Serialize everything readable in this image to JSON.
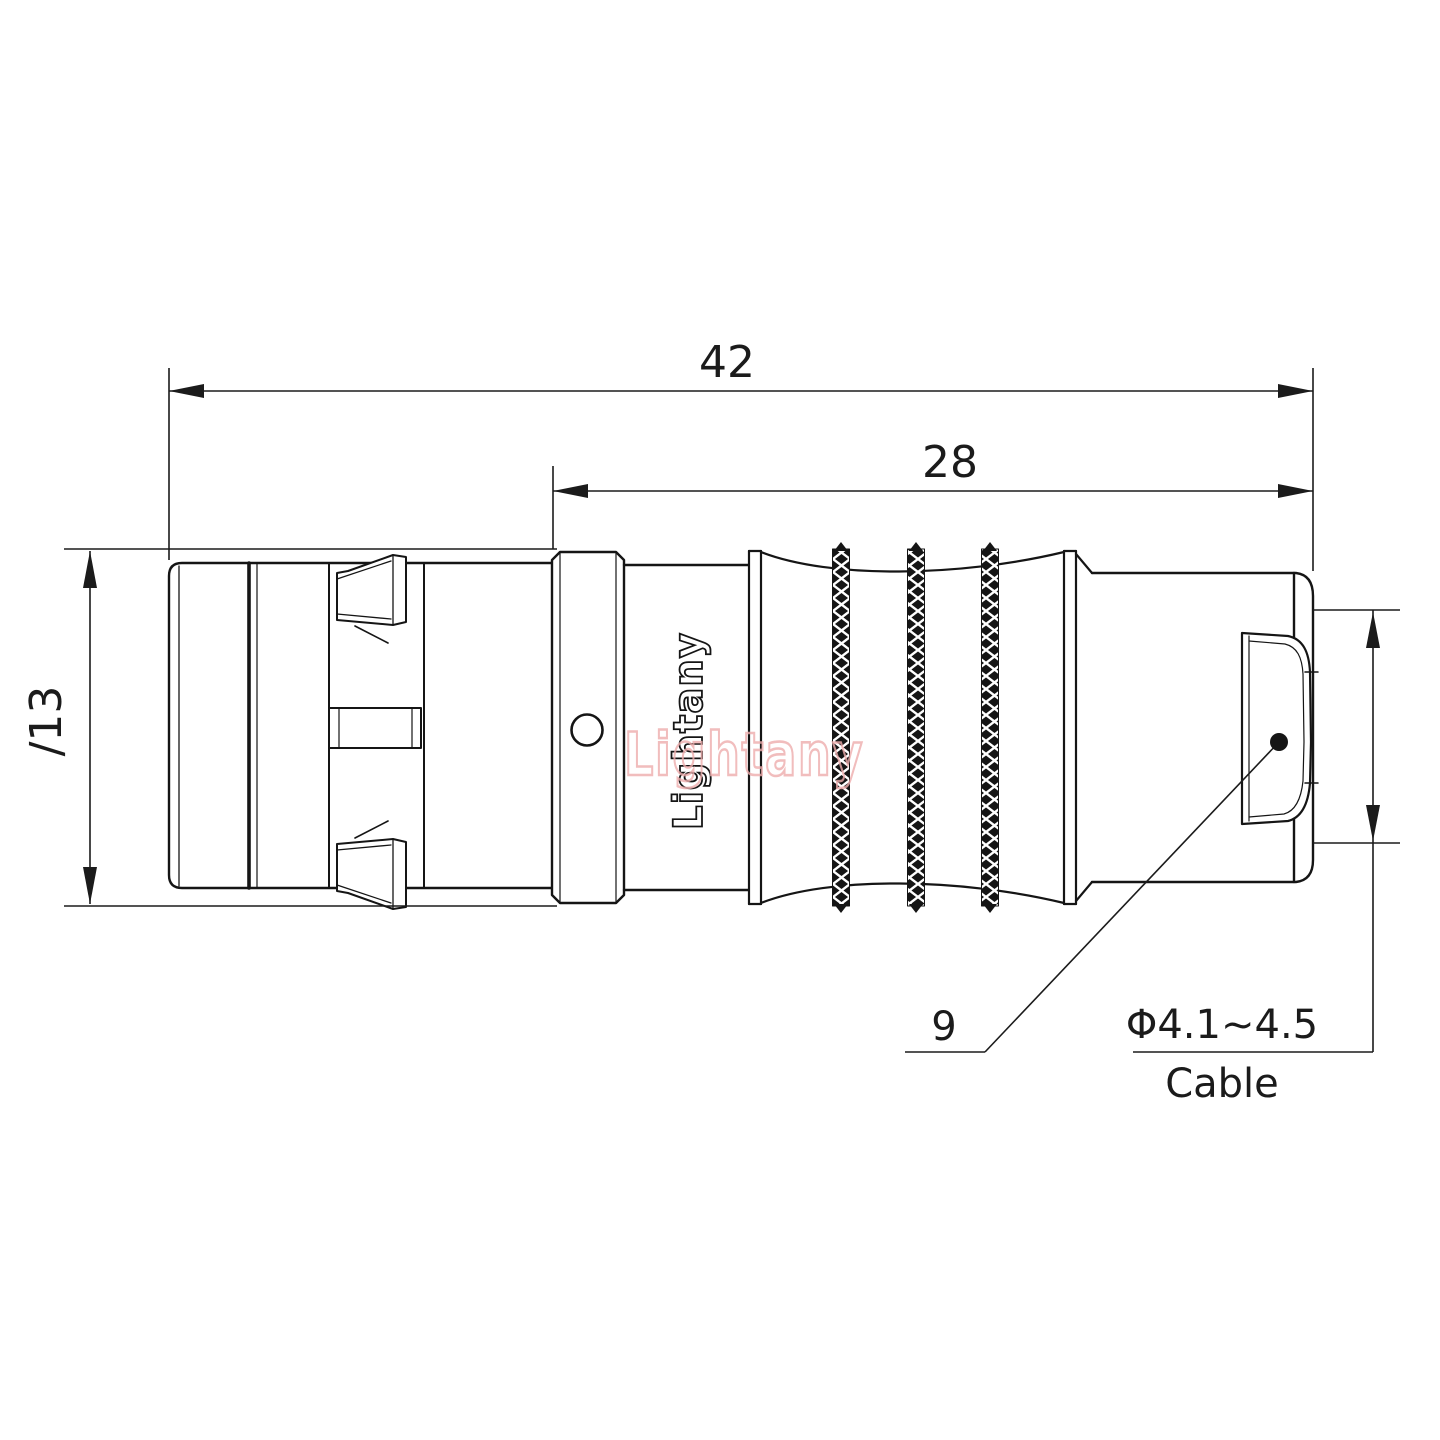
{
  "page": {
    "background": "#ffffff"
  },
  "drawing": {
    "type": "connector-technical-drawing",
    "line_color": "#151515",
    "dim_overall_length": "42",
    "dim_body_length": "28",
    "dim_diameter": "∕13",
    "dim_nut": "9",
    "dim_cable_value": "Φ4.1~4.5",
    "dim_cable_label": "Cable",
    "brand_engraving": "Lightany",
    "watermark_text": "Lightany",
    "watermark_color": "#eeadad"
  }
}
